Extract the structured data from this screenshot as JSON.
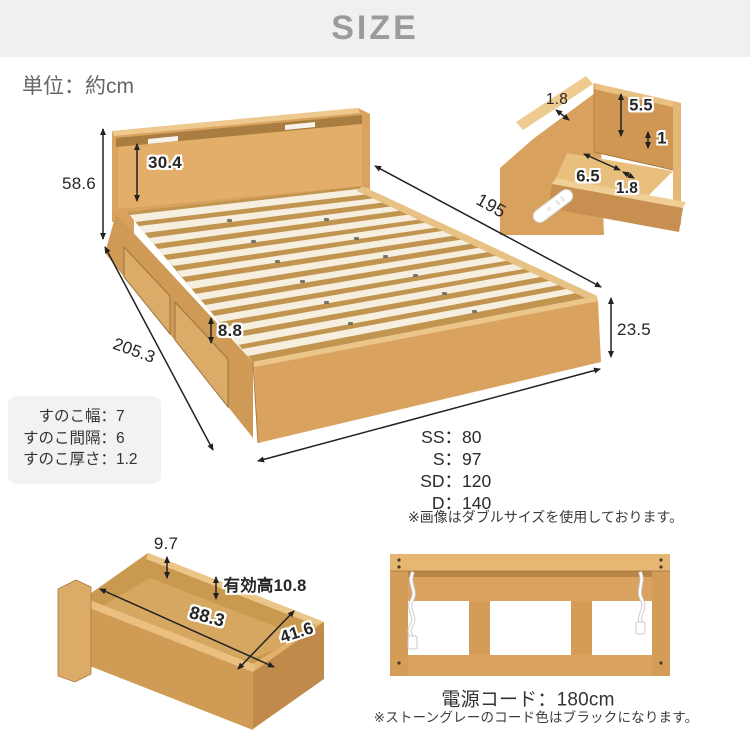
{
  "header": {
    "title": "SIZE"
  },
  "unit_note": "単位：約cm",
  "bed": {
    "dim_total_height": "58.6",
    "dim_panel_height": "30.4",
    "dim_length_inner": "195",
    "dim_rail_height": "8.8",
    "dim_length_total": "205.3",
    "dim_base_height": "23.5",
    "sizes": [
      {
        "label": "SS：",
        "value": "80"
      },
      {
        "label": "S：",
        "value": "97"
      },
      {
        "label": "SD：",
        "value": "120"
      },
      {
        "label": "D：",
        "value": "140"
      }
    ],
    "size_note": "※画像はダブルサイズを使用しております。"
  },
  "shelf_detail": {
    "dim_back_thickness": "1.8",
    "dim_inner_height": "5.5",
    "dim_ledge": "1",
    "dim_depth": "6.5",
    "dim_front_thickness": "1.8"
  },
  "slat_box": {
    "rows": [
      {
        "label": "すのこ幅：",
        "value": "7"
      },
      {
        "label": "すのこ間隔：",
        "value": "6"
      },
      {
        "label": "すのこ厚さ：",
        "value": "1.2"
      }
    ]
  },
  "drawer": {
    "dim_side_height": "9.7",
    "dim_effective_height": "有効高10.8",
    "dim_length": "88.3",
    "dim_width": "41.6"
  },
  "headboard_rear": {
    "cord_length": "電源コード：180cm",
    "note": "※ストーングレーのコード色はブラックになります。"
  },
  "colors": {
    "header_bg": "#f0f0f0",
    "header_text": "#9b9b9b",
    "wood_main": "#d9a35f",
    "wood_light": "#ecc588",
    "wood_dark": "#c08b4d",
    "slat_cream": "#f6efdf",
    "dim_text": "#262626"
  }
}
